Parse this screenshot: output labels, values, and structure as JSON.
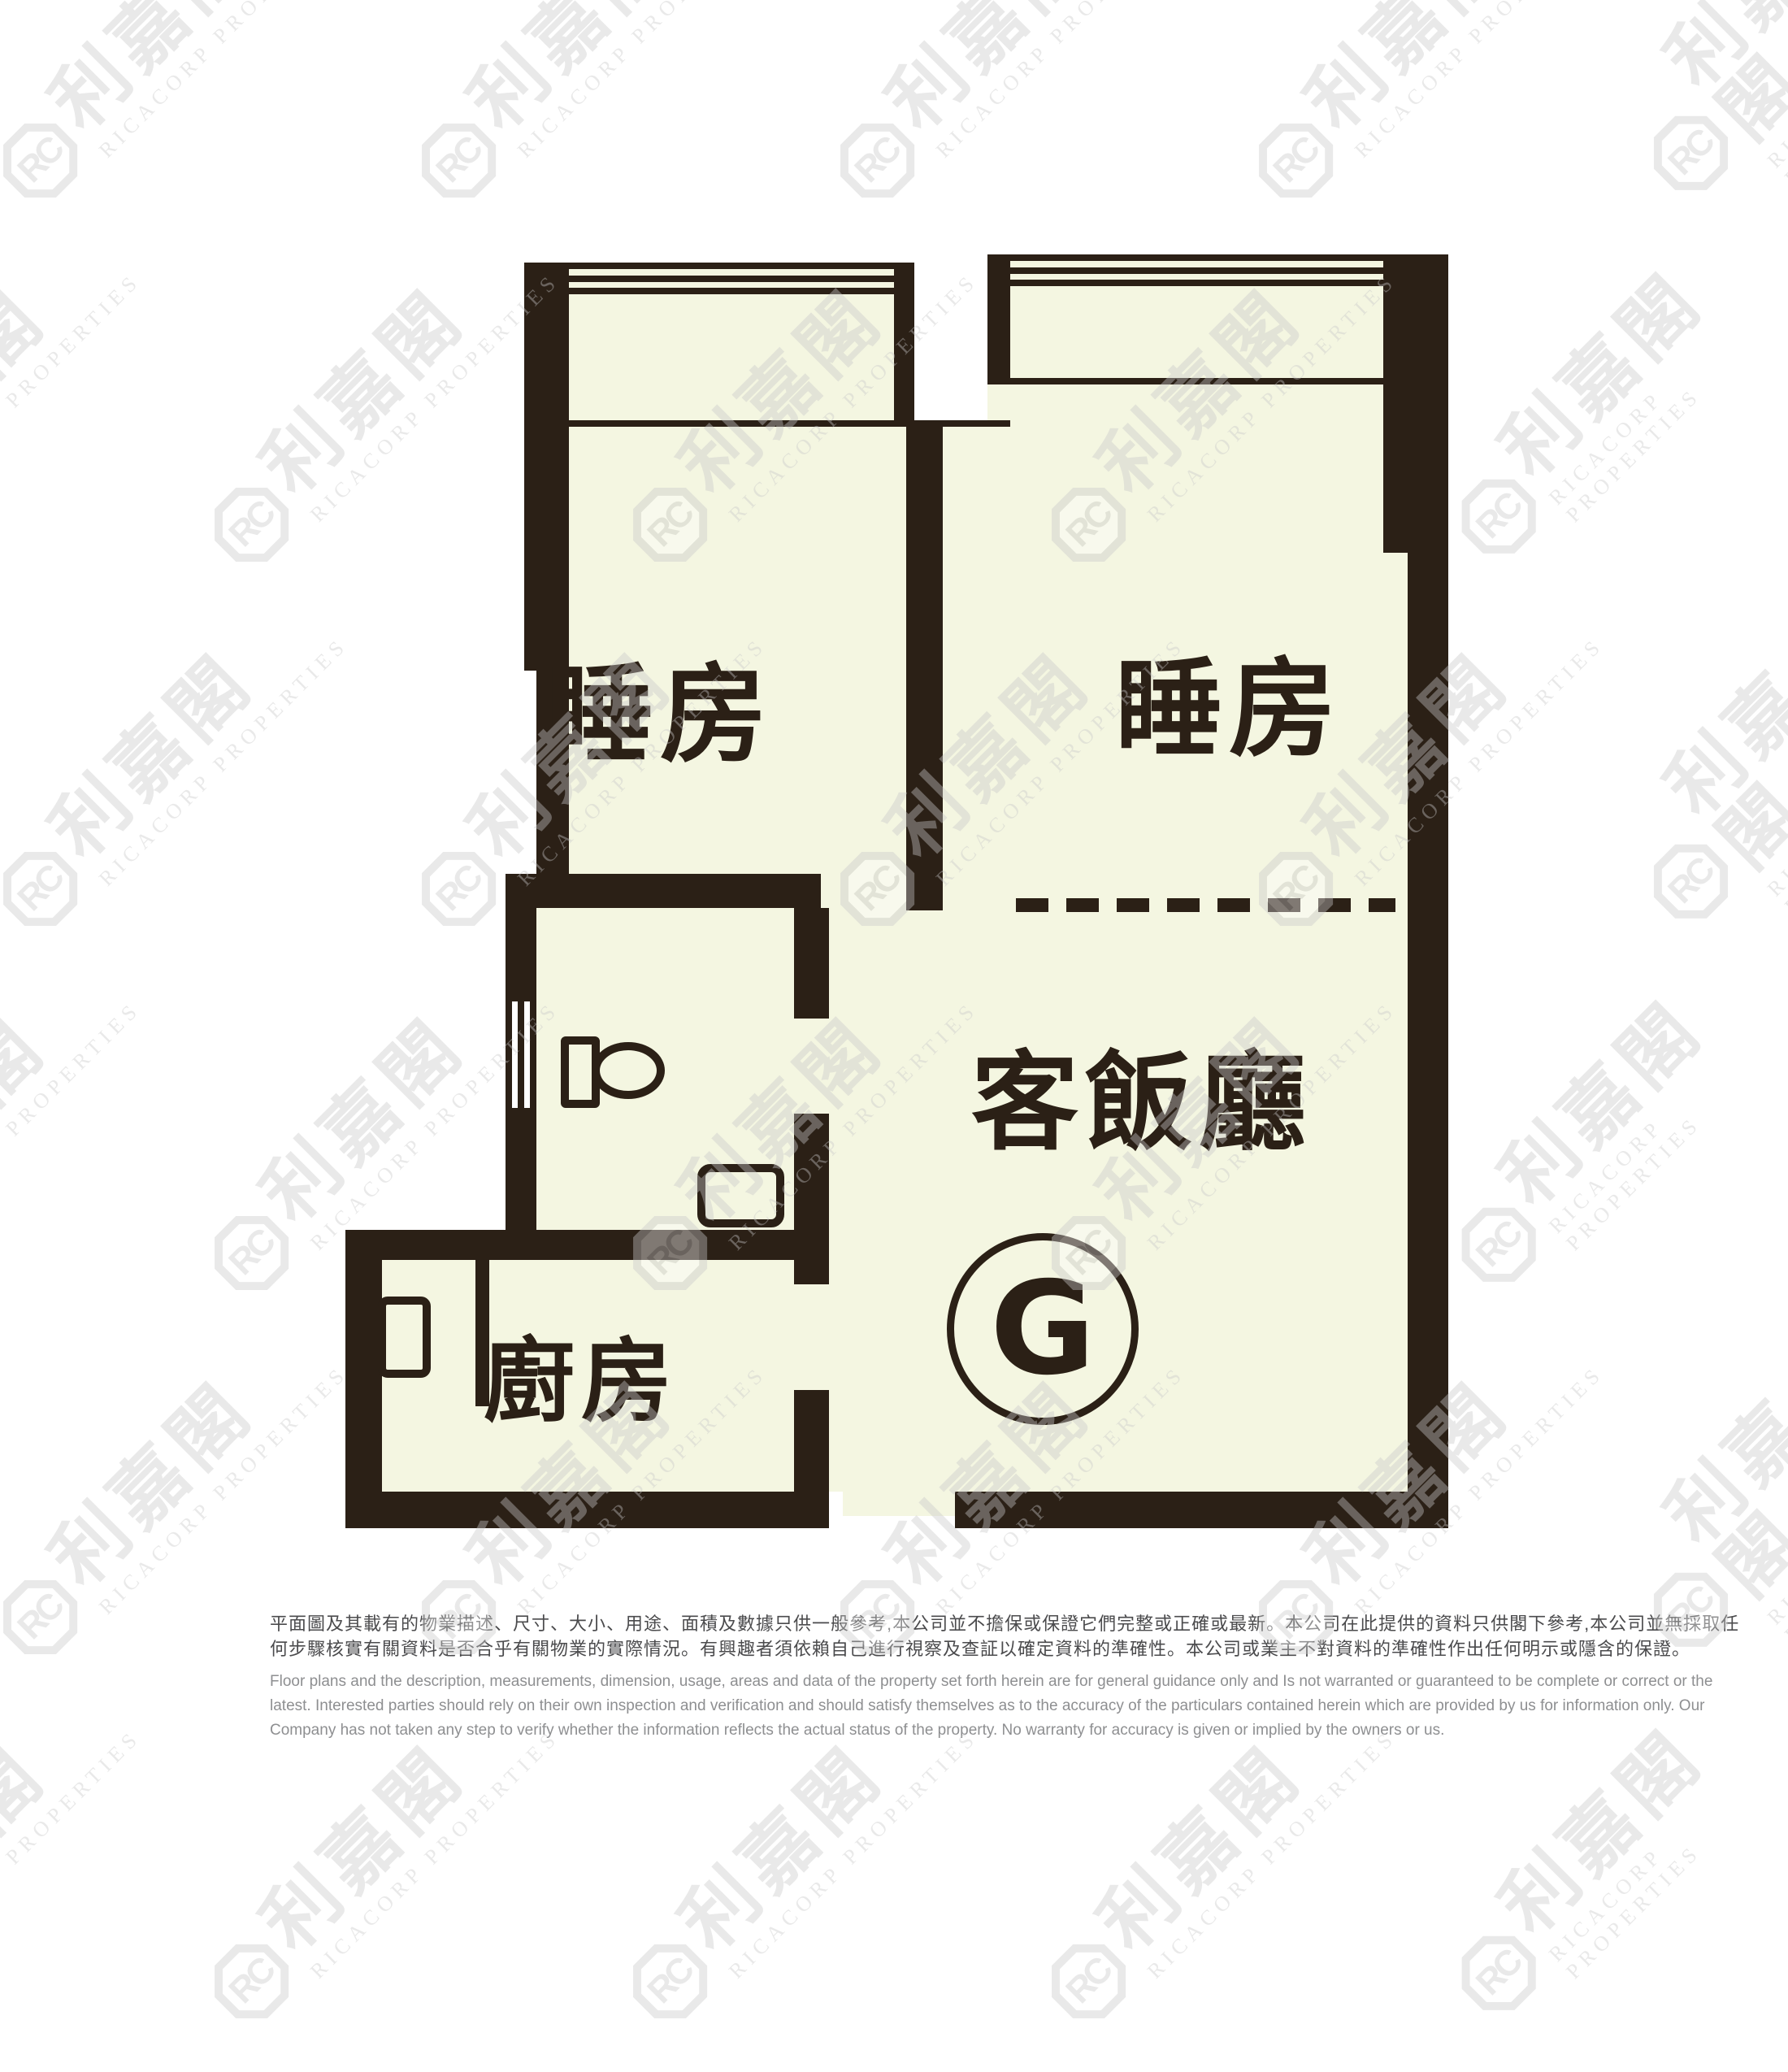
{
  "colors": {
    "wall": "#2b2016",
    "floor_fill": "#f4f6e1",
    "watermark_gray": "#c9c9c9",
    "disclaimer_zh_text": "#4b4b4d",
    "disclaimer_en_text": "#8e8f91",
    "background": "#ffffff"
  },
  "watermark": {
    "logo_text": "RC",
    "brand_zh": "利嘉閣",
    "brand_en": "RICACORP PROPERTIES"
  },
  "rooms": {
    "bedroom1_label": "睡房",
    "bedroom2_label": "睡房",
    "living_dining_label": "客飯廳",
    "kitchen_label": "廚房"
  },
  "unit": {
    "label": "G"
  },
  "disclaimer": {
    "zh_line1": "平面圖及其載有的物業描述、尺寸、大小、用途、面積及數據只供一般參考,本公司並不擔保或保證它們完整或正確或最新。本公司在此提供的資料只供閣下參考,本公司並無採取任",
    "zh_line2": "何步驟核實有關資料是否合乎有關物業的實際情況。有興趣者須依賴自己進行視察及查証以確定資料的準確性。本公司或業主不對資料的準確性作出任何明示或隱含的保證。",
    "en_line1": "Floor plans and the description, measurements, dimension, usage, areas and data of the property set forth herein are for general guidance only and Is not warranted or guaranteed to be complete or correct or the",
    "en_line2": "latest. Interested parties should rely on their own inspection and verification and should satisfy themselves as to the accuracy of the particulars contained herein which are provided by us for information only.  Our",
    "en_line3": "Company has not taken any step to verify whether the information reflects the actual status of the property.  No warranty for accuracy is given or implied by the owners or us."
  }
}
